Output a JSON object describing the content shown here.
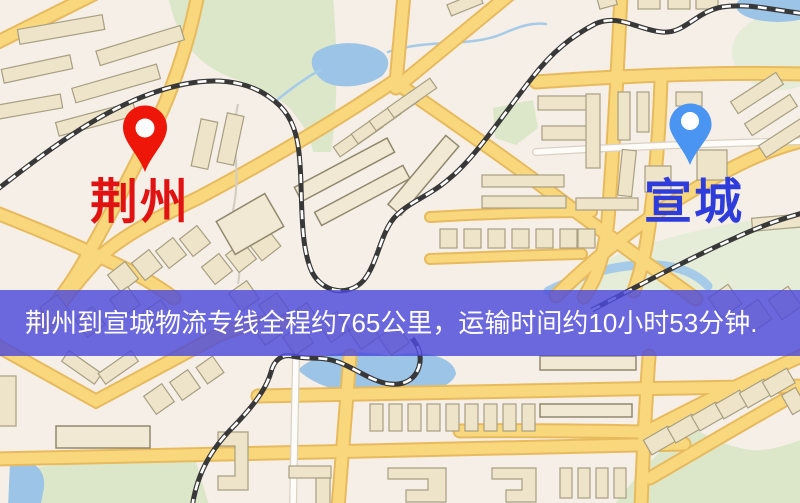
{
  "map": {
    "origin_marker": {
      "name": "荆州",
      "pin_color": "#ee1509",
      "label_color": "#e11212"
    },
    "destination_marker": {
      "name": "宣城",
      "pin_color": "#4a94f2",
      "label_color": "#2e3cdc"
    },
    "info_banner": {
      "text": "荆州到宣城物流专线全程约765公里，运输时间约10小时53分钟.",
      "distance": "约765公里",
      "duration": "约10小时53分钟",
      "background_rgba": "rgba(77,75,219,0.82)",
      "text_color": "#ffffff"
    },
    "palette": {
      "land": "#f5efe7",
      "park": "#dce7c9",
      "water": "#9cc4e6",
      "road_fill": "#f8d77d",
      "road_casing": "#e8ba5e",
      "building": "#ede4c9",
      "railway": "#383838"
    }
  }
}
